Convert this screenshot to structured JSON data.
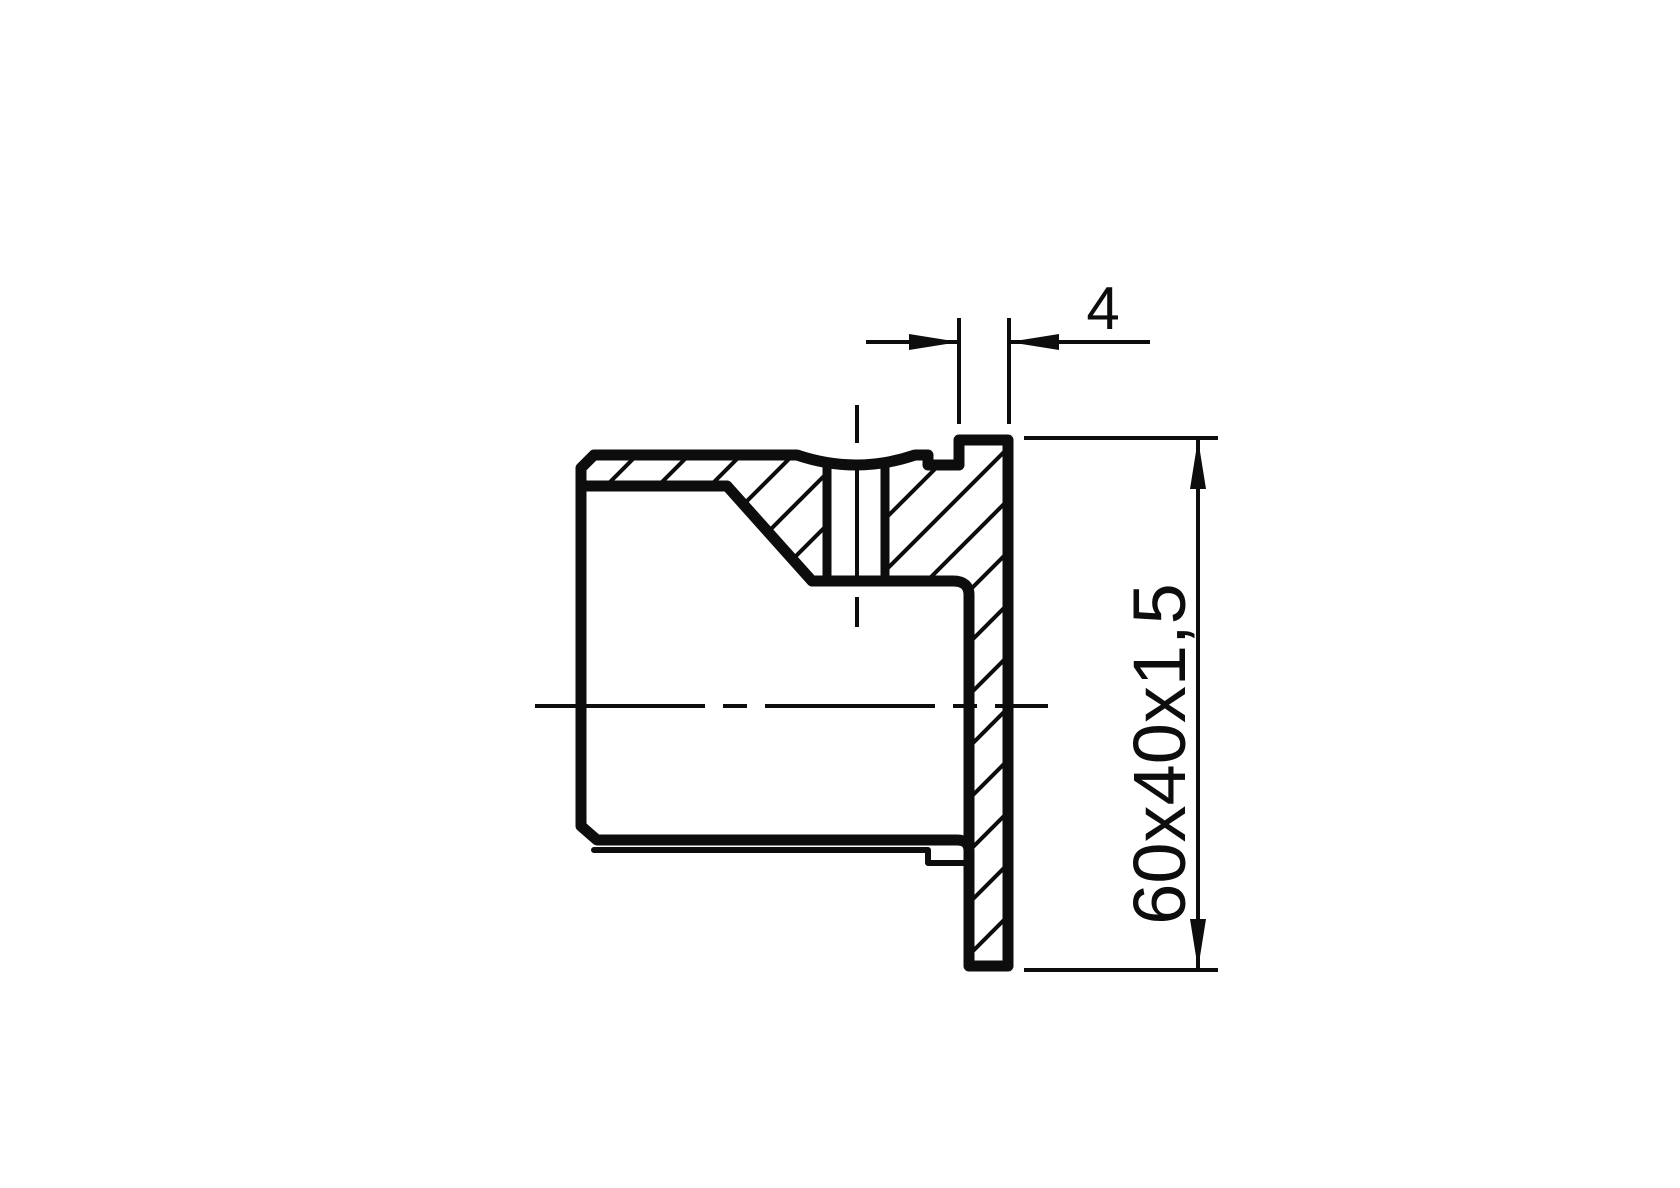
{
  "drawing": {
    "dimensions": {
      "flange_thickness": {
        "label": "4"
      },
      "tube_size": {
        "label": "60x40x1,5"
      }
    },
    "colors": {
      "line": "#0d0d0d",
      "background": "#ffffff"
    }
  }
}
